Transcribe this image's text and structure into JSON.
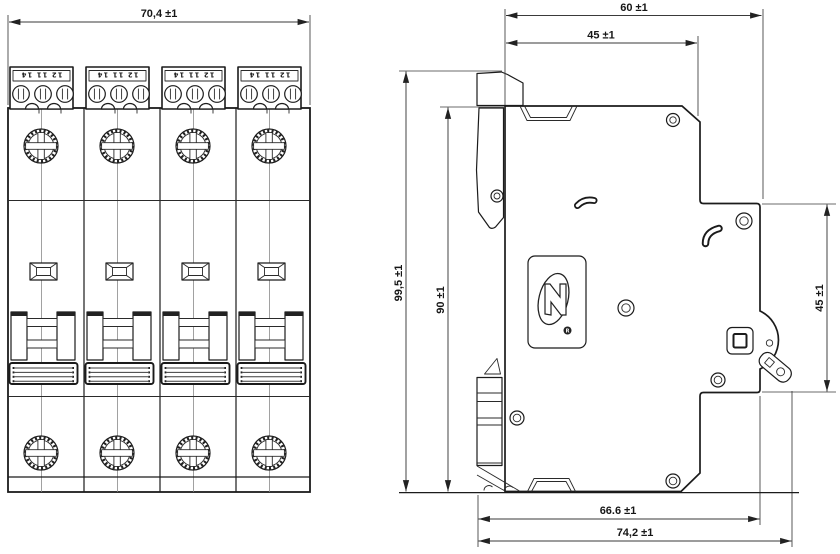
{
  "dimensions": {
    "front_width": "70,4 ±1",
    "depth_total": "60 ±1",
    "depth_front_step": "45 ±1",
    "height_overall": "99,5 ±1",
    "height_body": "90 ±1",
    "recess_height": "45 ±1",
    "base_depth": "66.6 ±1",
    "max_depth": "74,2 ±1"
  },
  "front_view": {
    "terminal_label": "12 11 14"
  },
  "side_view": {
    "registered_mark": "R"
  }
}
